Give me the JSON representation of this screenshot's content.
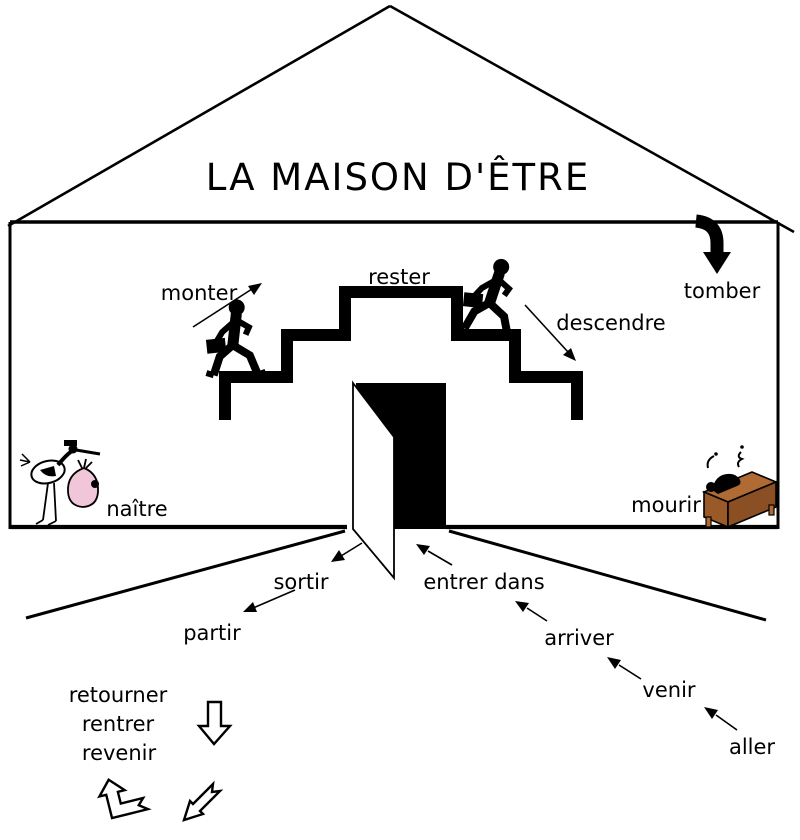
{
  "title": "LA MAISON D'ÊTRE",
  "verbs": {
    "monter": "monter",
    "rester": "rester",
    "descendre": "descendre",
    "tomber": "tomber",
    "naitre": "naître",
    "mourir": "mourir",
    "sortir": "sortir",
    "partir": "partir",
    "entrer_dans": "entrer dans",
    "arriver": "arriver",
    "venir": "venir",
    "aller": "aller",
    "retourner": "retourner",
    "rentrer": "rentrer",
    "revenir": "revenir"
  },
  "icons": {
    "runner_ascending": "running-man-with-briefcase",
    "runner_descending": "running-man-with-briefcase",
    "tomber_arrow": "thick-curved-down-arrow",
    "stork": "stork-carrying-baby-bundle",
    "death_desk": "figure-slumped-on-desk",
    "return_down": "hollow-down-arrow",
    "return_bent_up": "hollow-bent-up-arrow",
    "return_bent_down": "hollow-swallowtail-down-left-arrow"
  },
  "colors": {
    "ink": "#000000",
    "background": "#ffffff",
    "bundle_pink": "#f2c6d9",
    "desk_brown": "#b06a33",
    "desk_brown_dark": "#8a4f22"
  }
}
